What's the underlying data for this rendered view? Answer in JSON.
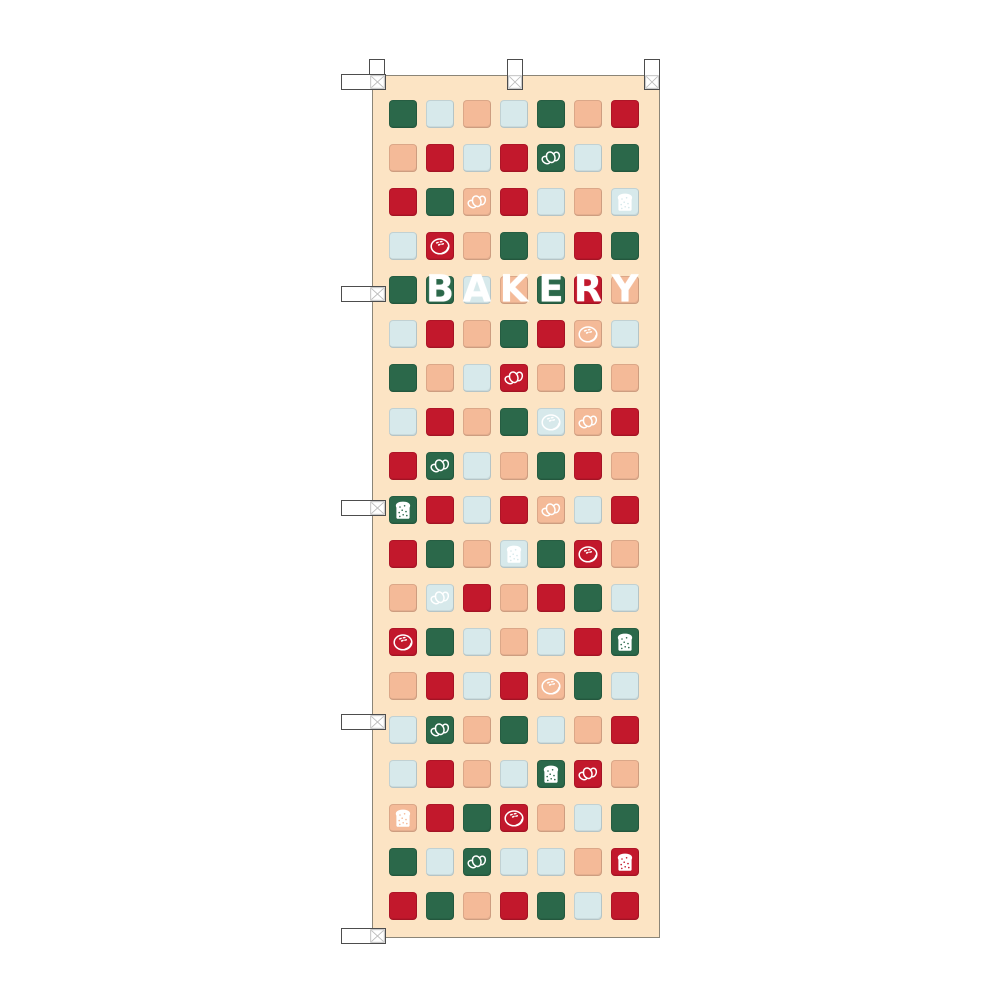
{
  "banner": {
    "text": "BAKERY",
    "letters": [
      "B",
      "A",
      "K",
      "E",
      "R",
      "Y"
    ],
    "colors": {
      "page_background": "#ffffff",
      "background_cream": "#fce4c4",
      "green": "#2b684a",
      "red": "#c2182c",
      "peach": "#f4ba98",
      "light_blue": "#d7e9eb",
      "icon_white": "#ffffff",
      "banner_border": "#8b8577",
      "tab_border": "#4d4d4d",
      "stitch_gray": "#bcbcbc"
    },
    "legend": {
      "G": "green",
      "R": "red",
      "P": "peach",
      "B": "light_blue",
      "c": "croissant-icon",
      "t": "toast-icon",
      "b": "bun-icon",
      ":X": "white letter X on square"
    },
    "grid_rows": [
      "G B P B G P R",
      "P R B R Gc B G",
      "R G Pc R B P Bt",
      "B Rb P G B R G",
      "G G:B B:A P:K G:E R:R P:Y",
      "B R P G R Pb B",
      "G P B Rc P G P",
      "B R P G Bb Pc R",
      "R Gc B P G R P",
      "Gt R B R Pc B R",
      "R G P Bt G Rb P",
      "P Bc R P R G B",
      "Rb G B P B R Gt",
      "P R B R Pb G B",
      "B Gc P G B P R",
      "B R P B Gt Rc P",
      "Pt R G Rb P B G",
      "G B Gc B B P Rt",
      "R G P R G B R"
    ],
    "icons": [
      "croissant-icon",
      "toast-icon",
      "bun-icon"
    ]
  }
}
